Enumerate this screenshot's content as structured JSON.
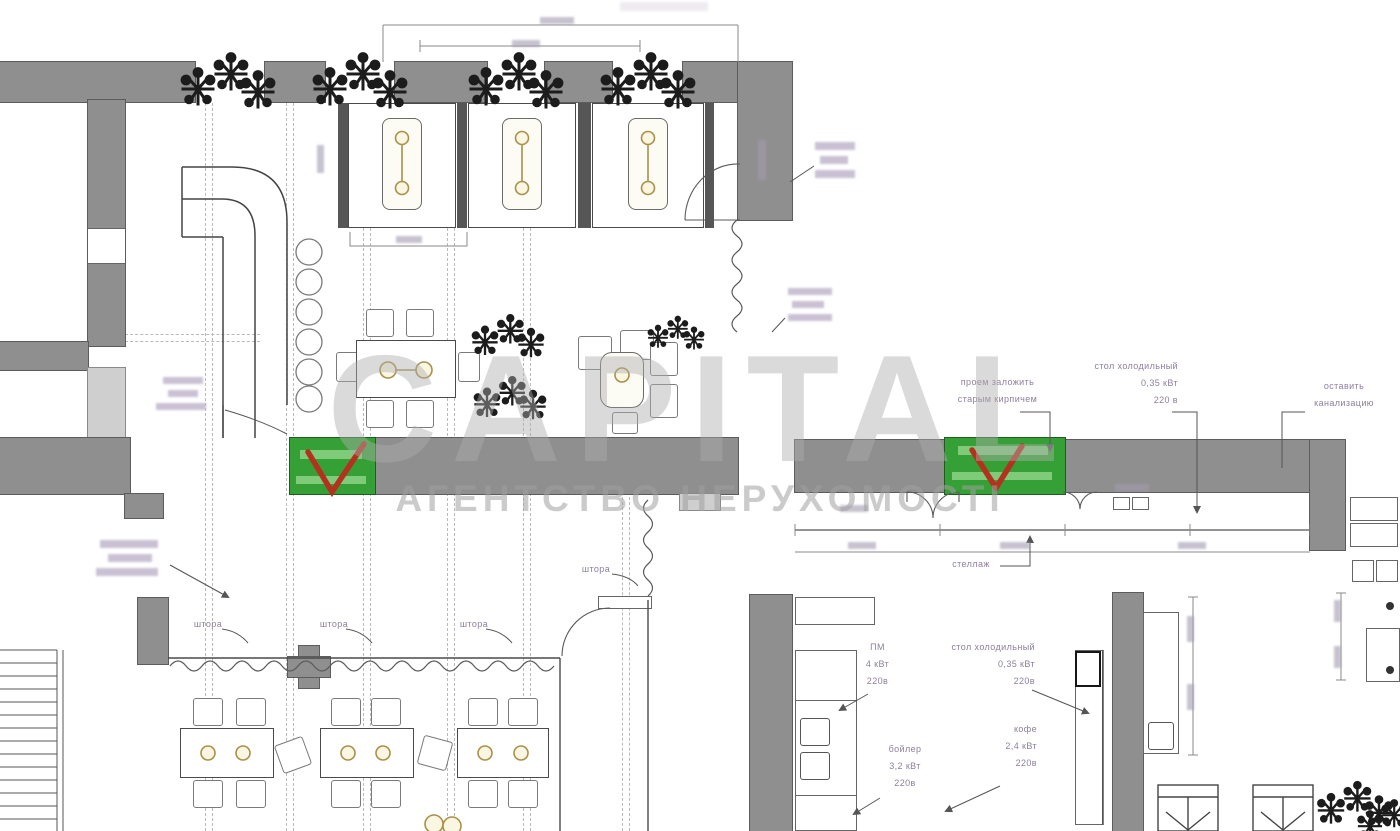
{
  "watermark": {
    "brand": "CAPITAL",
    "tagline": "АГЕНТСТВО НЕРУХОМОСТІ"
  },
  "colors": {
    "wall": "#8f8f8f",
    "zone_green": "#35a035",
    "check_red": "#b5311f",
    "annotation_purple": "#8d7f9c"
  },
  "annotations": {
    "curtain_label": "штора",
    "shelf_label": "стеллаж",
    "brick_opening": {
      "line1": "проем заложить",
      "line2": "старым кирпичем"
    },
    "fridge_table_top": {
      "line1": "стол холодильный",
      "line2": "0,35 кВт",
      "line3": "220 в"
    },
    "keep_sewer": {
      "line1": "оставить",
      "line2": "канализацию"
    },
    "dishwasher": {
      "line1": "ПМ",
      "line2": "4 кВт",
      "line3": "220в"
    },
    "fridge_table_kitchen": {
      "line1": "стол холодильный",
      "line2": "0,35 кВт",
      "line3": "220в"
    },
    "coffee": {
      "line1": "кофе",
      "line2": "2,4 кВт",
      "line3": "220в"
    },
    "boiler": {
      "line1": "бойлер",
      "line2": "3,2 кВт",
      "line3": "220в"
    }
  }
}
